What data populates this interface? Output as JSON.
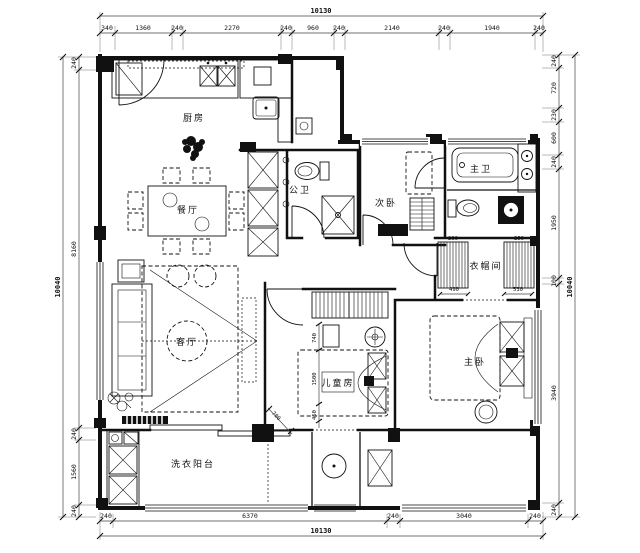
{
  "drawing": {
    "type": "apartment-floor-plan",
    "style": "CAD black-and-white"
  },
  "colors": {
    "ink": "#111111",
    "paper": "#ffffff"
  },
  "rooms": {
    "kitchen": "厨房",
    "dining": "餐厅",
    "guest_bath": "公卫",
    "second_bedroom": "次卧",
    "master_bath": "主卫",
    "closet": "衣帽间",
    "living": "客厅",
    "kids_room": "儿童房",
    "master_bedroom": "主卧",
    "laundry_balcony": "洗衣阳台"
  },
  "dims": {
    "top": {
      "total": "10130",
      "segments": [
        "340",
        "1360",
        "240",
        "2270",
        "240",
        "960",
        "240",
        "2140",
        "240",
        "1940",
        "240"
      ]
    },
    "bottom": {
      "total": "10130",
      "segments": [
        "240",
        "6370",
        "240",
        "3040",
        "240"
      ]
    },
    "left": {
      "total": "10040",
      "segments": [
        "240",
        "8160",
        "240",
        "1560",
        "240"
      ]
    },
    "right": {
      "total": "10040",
      "segments": [
        "240",
        "720",
        "230",
        "600",
        "240",
        "1950",
        "100",
        "3940",
        "240"
      ]
    },
    "inner": {
      "closet_left": "490",
      "closet_right": "530",
      "ward_left": "290",
      "ward_right": "250",
      "kids_a": "740",
      "kids_b": "1500",
      "kids_c": "450",
      "kids_diag": "700"
    }
  }
}
